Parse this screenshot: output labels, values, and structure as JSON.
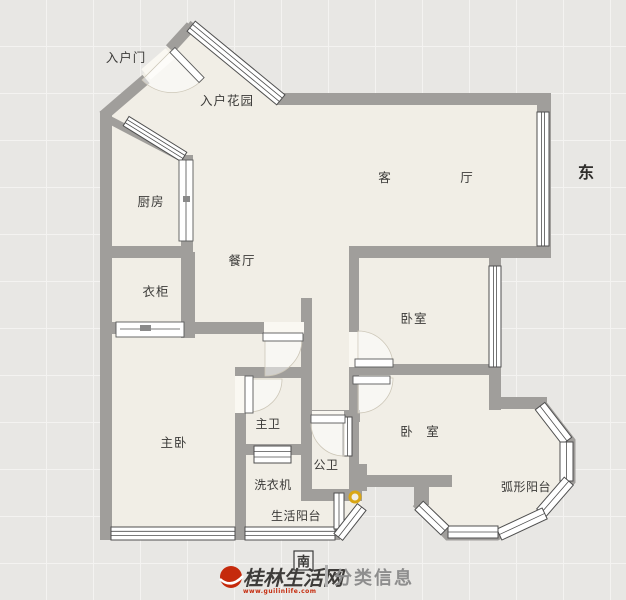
{
  "plan": {
    "labels": {
      "entry_door": "入户门",
      "entry_garden": "入户花园",
      "kitchen": "厨房",
      "dining": "餐厅",
      "living_left": "客",
      "living_right": "厅",
      "wardrobe": "衣柜",
      "bedroom1": "卧室",
      "master_bedroom": "主卧",
      "master_bath": "主卫",
      "public_bath": "公卫",
      "washer": "洗衣机",
      "service_balcony": "生活阳台",
      "bedroom2_left": "卧",
      "bedroom2_right": "室",
      "arc_balcony": "弧形阳台"
    },
    "compass": {
      "east": "东",
      "south": "南"
    }
  },
  "watermark": {
    "site_name": "桂林生活网",
    "site_url": "www.guilinlife.com",
    "section": "分类信息"
  },
  "colors": {
    "wall": "#a09e9b",
    "floor": "#f1eee6",
    "background": "#e8e7e4",
    "window_frame": "#4f4f4f",
    "logo_red": "#c52a0c",
    "gold_marker": "#d9a614"
  }
}
